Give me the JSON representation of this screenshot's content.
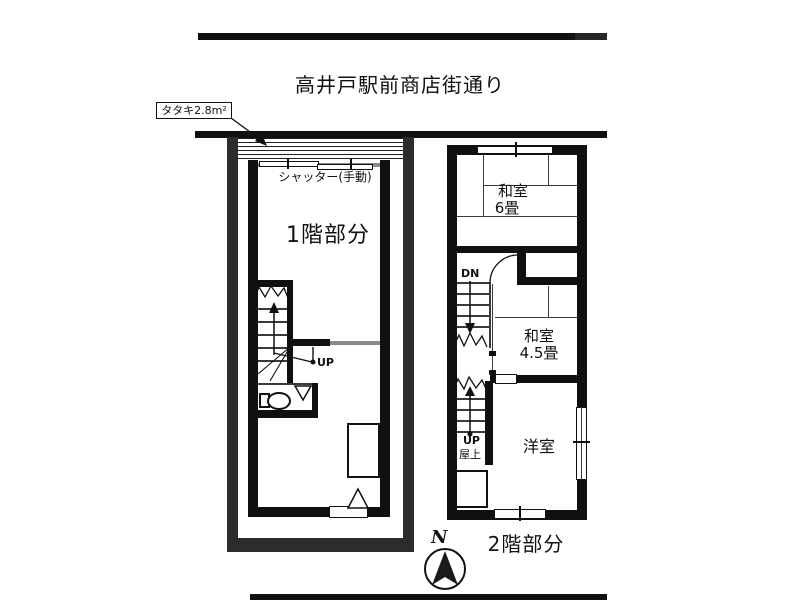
{
  "street": {
    "name": "高井戸駅前商店街通り"
  },
  "site": {
    "tataki_label": "タタキ2.8m²"
  },
  "floor1": {
    "title": "1階部分",
    "shutter_label": "シャッター(手動)",
    "stairs": {
      "up_label": "UP"
    }
  },
  "floor2": {
    "title": "2階部分",
    "rooms": {
      "washitsu6": {
        "name": "和室",
        "size": "6畳"
      },
      "washitsu45": {
        "name": "和室",
        "size": "4.5畳"
      },
      "youshitsu": {
        "name": "洋室"
      }
    },
    "stairs": {
      "down_label": "DN",
      "up_label": "UP",
      "destination": "屋上"
    }
  },
  "compass": {
    "north": "N"
  },
  "colors": {
    "ink": "#111111",
    "site_boundary": "#2c2c2c",
    "shutter_gray": "#8a8a8a",
    "background": "#ffffff"
  }
}
